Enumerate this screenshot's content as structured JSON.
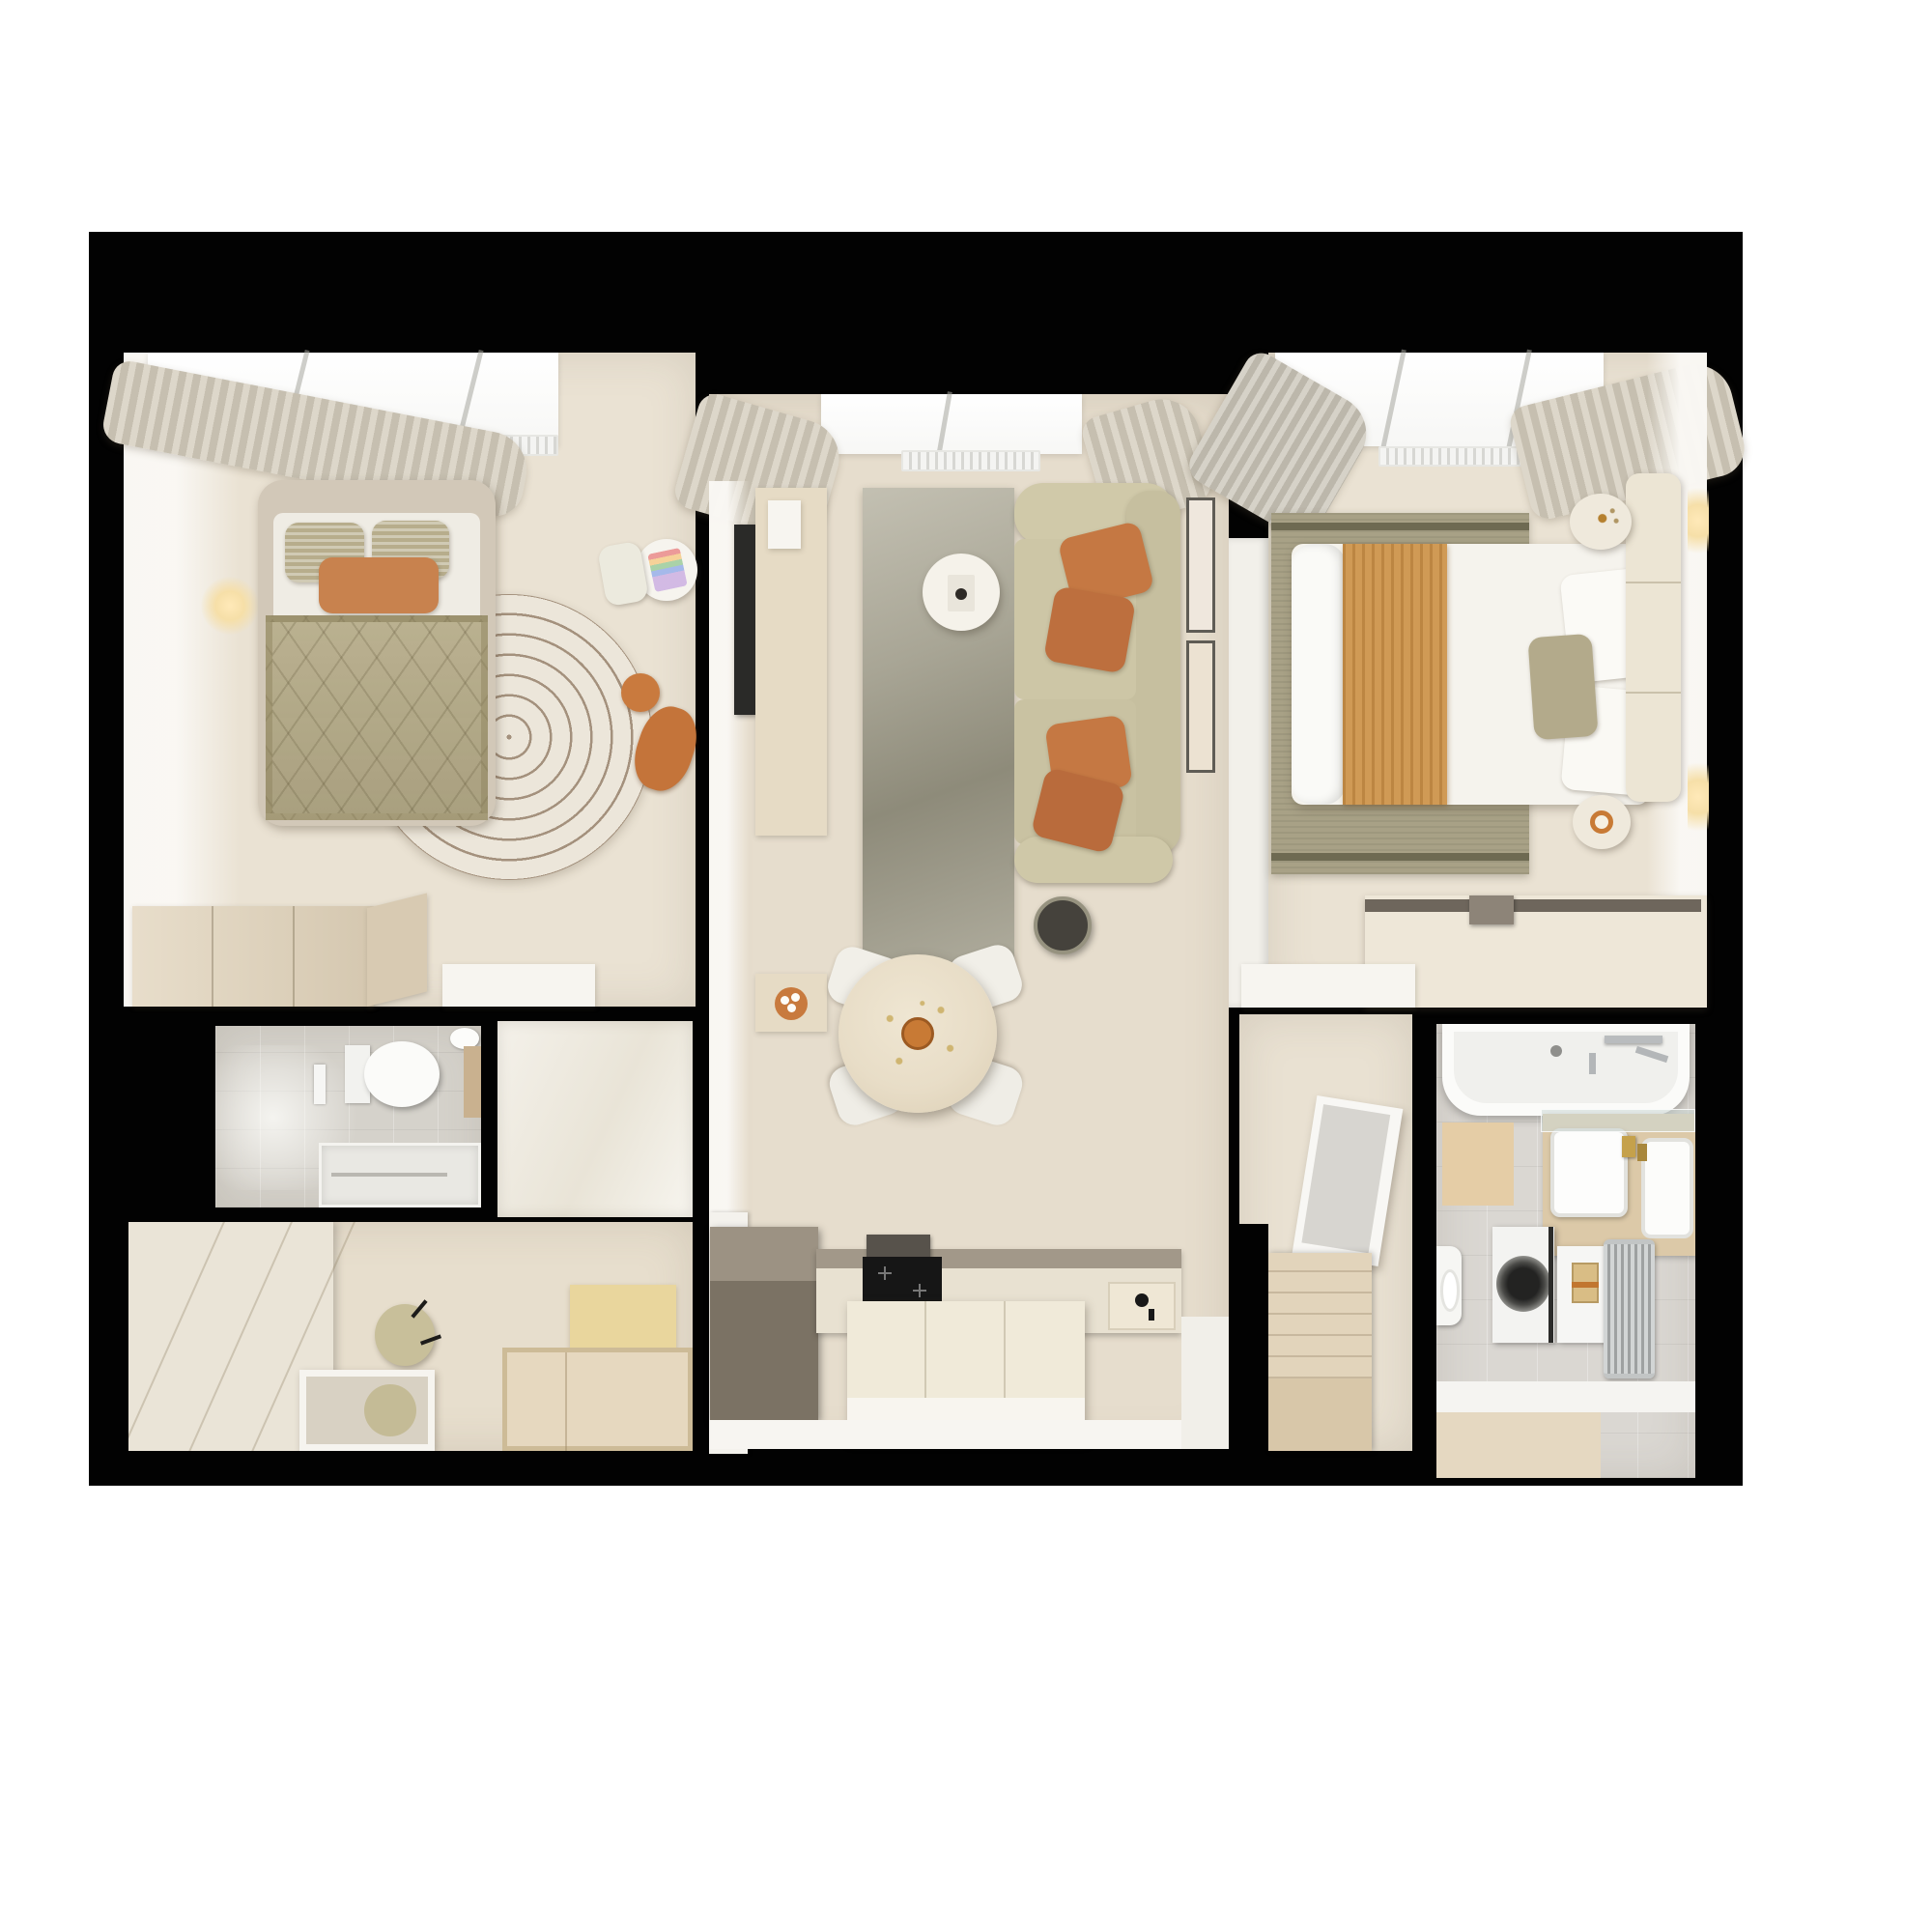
{
  "meta": {
    "title": "Photorealistic top-down 3D floor plan render of a two-bedroom apartment",
    "view": "top-down orthographic render",
    "background": "white page, apartment outlined by thick black walls",
    "visible_text": "none"
  },
  "palette": {
    "black": "#020202",
    "page": "#ffffff",
    "floor": "#eae2d3",
    "floor2": "#e6ddcd",
    "tile": "#d5d2cb",
    "tileB": "#dad7d2",
    "wall": "#f6f4f0",
    "cream": "#ebe5d7",
    "woodMid": "#e0d2b9",
    "woodDeep": "#d6c5a7",
    "counterDark": "#7d7466",
    "counterTop": "#a29889",
    "stone": "#e8e1d1",
    "sofa": "#cbc4a4",
    "oliveBed": "#b4aa87",
    "olivePillow": "#b7ad8c",
    "rust": "#c47843",
    "caramel": "#d09a55",
    "rugLeftBase": "#ece6da",
    "rugLeftLine": "#a4917d",
    "rugMid1": "#c3c0b2",
    "rugMid2": "#8e8b7a",
    "rugRight": "#a8a186",
    "rugRightDark": "#6e6a52",
    "lampDark": "#45423c",
    "steel": "#c6c9c9",
    "gold": "#c5a14b",
    "matYellow": "#e9d69d",
    "glowWarm": "#f8e8c2",
    "dark": "#2a2927"
  },
  "rooms": [
    {
      "id": "bedroom-left",
      "name": "Bedroom 1 (top left)",
      "furniture": [
        "double bed with greige upholstered frame",
        "two olive patterned pillows",
        "rust lumbar pillow",
        "quilted olive chevron duvet",
        "round maze-pattern rug",
        "orange toy figure",
        "kids round table with drawing",
        "kids chair",
        "wall sconce",
        "curtain",
        "radiator",
        "window",
        "low wood dresser",
        "white bench"
      ]
    },
    {
      "id": "living-kitchen",
      "name": "Living room with open kitchen (center)",
      "furniture": [
        "beige L-sofa with four rust pillows",
        "gradient gray-green rug",
        "round white coffee table",
        "wall TV",
        "wood media console",
        "two wall frames",
        "black floor lamp",
        "round wood dining table",
        "four white chairs",
        "orange centerpiece",
        "taupe kitchen cabinet",
        "stone counter with black cooktop and hood",
        "sink niche with black tap",
        "cream kitchen island",
        "white half wall",
        "curtains",
        "radiator",
        "window"
      ]
    },
    {
      "id": "bedroom-right",
      "name": "Bedroom 2 (top right)",
      "furniture": [
        "double bed with white duvet",
        "caramel striped throw",
        "two white pillows",
        "olive accent pillow",
        "cream panel headboard",
        "olive bordered rug",
        "two round nightstands",
        "plant sprig",
        "orange cup",
        "two wall light strips",
        "desk with dark rail and lamp",
        "white corner shelf",
        "curtains",
        "radiator",
        "window"
      ]
    },
    {
      "id": "wc",
      "name": "WC / shower room (lower left)",
      "furniture": [
        "wall-hung toilet",
        "flush plate",
        "corner basin with wood vanity",
        "walk-in shower tray with linear drain",
        "gray tiled floor"
      ]
    },
    {
      "id": "study",
      "name": "Study / dressing room (bottom left)",
      "furniture": [
        "cream wardrobe column",
        "vanity table with recessed mirror",
        "two olive stools with black legs",
        "yellow mat",
        "low wood platform",
        "white wardrobe block"
      ]
    },
    {
      "id": "hallway",
      "name": "Hallway (bottom right of center)",
      "furniture": [
        "leaning white mirror panel",
        "wood storage bench with slats"
      ]
    },
    {
      "id": "bathroom",
      "name": "Bathroom / laundry (bottom right)",
      "furniture": [
        "bathtub with chrome wall faucet",
        "beige bath mat",
        "glass shelf",
        "wood vanity with two white sinks and gold taps",
        "washing machine",
        "white cabinet with striped towel",
        "chrome bar radiator",
        "toilet",
        "gray tile floor",
        "wood entry strip"
      ]
    }
  ]
}
